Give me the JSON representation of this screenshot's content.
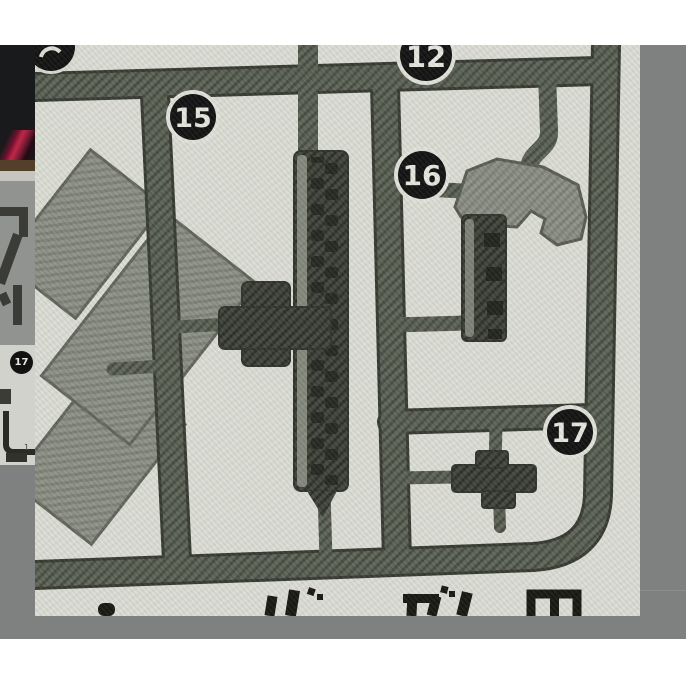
{
  "page": {
    "background_color": "#ffffff"
  },
  "carousel": {
    "background_color": "#7f8080",
    "description_colors": {
      "photo_background": "#dcddd5",
      "sprue_plastic": "#5e6357"
    }
  },
  "previous_thumbnail": {
    "glyph": "マ",
    "badge_label": "17",
    "card_mark": "1"
  },
  "photo": {
    "subject": "plastic-model-kit-sprue",
    "badges": [
      {
        "label": "15"
      },
      {
        "label": "12"
      },
      {
        "label": "16"
      },
      {
        "label": "17"
      }
    ],
    "caption_visible": "ガん田"
  }
}
